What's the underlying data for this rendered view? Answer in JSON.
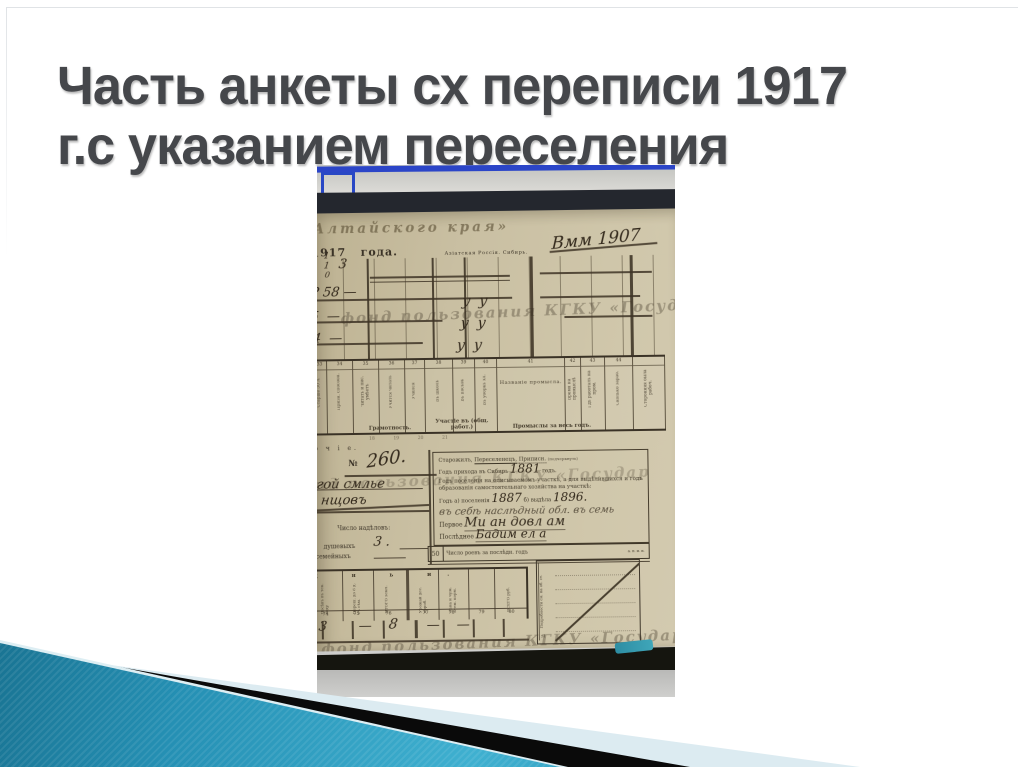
{
  "title": {
    "line1": "Часть анкеты сх переписи 1917",
    "line2": "г.с указанием переселения"
  },
  "photo": {
    "description": "Фотография экрана со сканом анкеты сельскохозяйственной переписи 1917 года",
    "doc": {
      "corner_header": "Алтайского края»",
      "year": "1917   года.",
      "region": "Азіатская Россія. Сибирь.",
      "scribble": "Вмм 1907",
      "grid_hand": {
        "d1": "1",
        "d2": "1",
        "d3": "0",
        "d4": "3",
        "r1": "Р 58 —",
        "r2": "5  —",
        "r3": "4  —",
        "c1": "у  у",
        "c2": "у  у",
        "c3": "у  у"
      },
      "head_nums": [
        "33",
        "34",
        "35",
        "36",
        "37",
        "38",
        "39",
        "40",
        "41",
        "42",
        "43",
        "44"
      ],
      "head_rot": [
        "Старше 50 л.",
        "Призн. способн.",
        "Читать и пис. умѣетъ",
        "Учится читать",
        "Учился",
        "Въ школѣ",
        "Въ посѣвѣ",
        "Въ уборкѣ хл.",
        "",
        "Время на промыслѣ",
        "Гдѣ работалъ на пром.",
        "Сколько зараб.",
        "Сторонняя была рабоч."
      ],
      "big_cell": "Названіе промысла.",
      "groups": [
        "Грамотность.",
        "Участіе въ (общ. работ.)",
        "Промыслы за весь годъ."
      ],
      "foot_nums": "18             19             20             21",
      "bochie": "о ч і е.",
      "no_label": "№",
      "no_value": "260.",
      "hand_name1": "гой смлье",
      "hand_name2": "нщовъ",
      "nad_label": "Число надѣловъ:",
      "nad_row1_label": "душевыхъ",
      "nad_row1_value": "3 .",
      "nad_row2_label": "семейныхъ",
      "right_line1a": "Старожилъ,",
      "right_line1b": "Переселенецъ,",
      "right_line1c": "Приписн.",
      "right_line1d": "(подчеркнуть)",
      "right_line2": "Годъ прихода въ Сибирь",
      "right_line2_year": "1881",
      "right_line2_end": "годъ.",
      "right_para": "Годъ поселенія на описываемомъ участкѣ, а для выдѣлившихся и годъ образованія самостоятельнаго хозяйства на участкѣ:",
      "right_line3a": "Годъ а) поселенія",
      "right_line3_y1": "1887",
      "right_line3b": "б) выдѣла",
      "right_line3_y2": "1896.",
      "right_scrawl": "въ себѣ наслѣдный обл. въ семь",
      "first_label": "Первое",
      "first_value": "Ми ан довл ам",
      "last_label": "Послѣднее",
      "last_value": "Бадим ел а",
      "row50_num": "50",
      "row50_text": "Число роевъ за послѣдн. годъ",
      "row50_frac": "а. п.  и. п.",
      "btm_letters": "д н ь и.",
      "btm_rot": [
        "Посѣвъ въ тек. году",
        "Переш. до 6 д. съ сѣм.",
        "ИТОГО земл.",
        "Урожай дес. короб.",
        "Сѣна и чуж. атем. корм.",
        "ВСЕГО руб."
      ],
      "btm_nums": [
        "74",
        "75",
        "76",
        "77",
        "78",
        "79",
        "80"
      ],
      "btm_vals": [
        "3",
        "—",
        "8",
        "—",
        "—"
      ],
      "diag_label": "Подробности см. на об. ст.",
      "diag_num": "51",
      "watermark1": "фонд пользования КГКУ «Госуд",
      "watermark2": "нд пользования КГКУ «Государ",
      "watermark3": "фонд пользования КГКУ «Государ"
    }
  },
  "colors": {
    "title_text": "#45474b",
    "window_blue": "#2b45c8",
    "paper": "#c9bfa2",
    "deco_teal_dark": "#0f5c77",
    "deco_teal_light": "#3fb0d0",
    "deco_pale": "#dcebf1",
    "deco_black": "#0a0a0a"
  }
}
